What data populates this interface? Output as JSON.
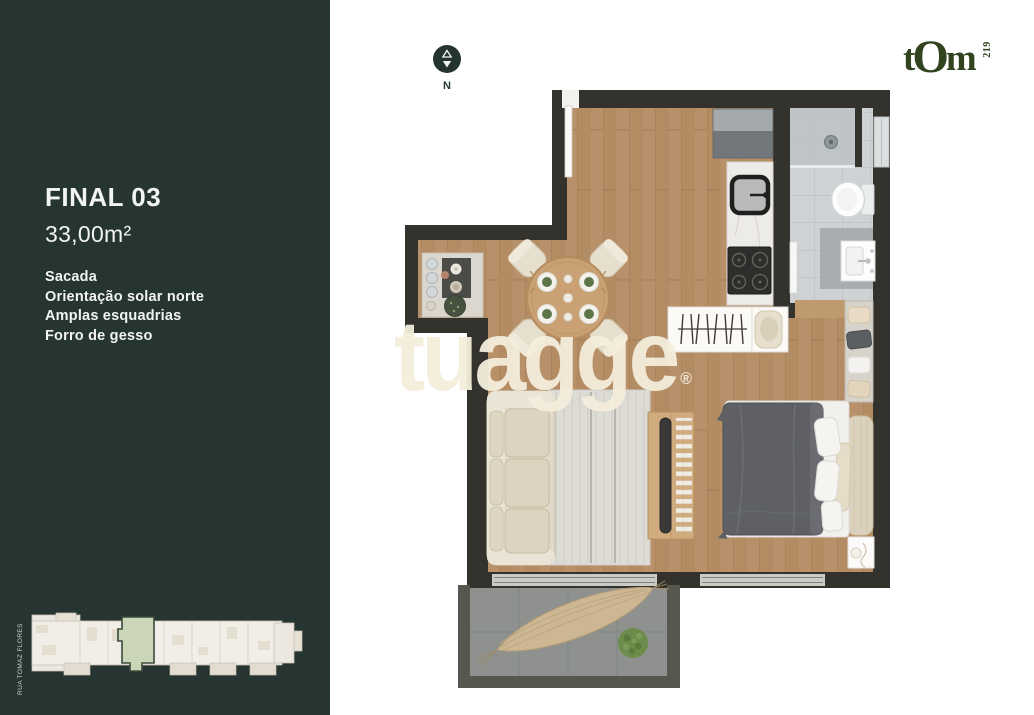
{
  "sidebar": {
    "unit_label": "FINAL 03",
    "area_label": "33,00m²",
    "features": [
      "Sacada",
      "Orientação solar norte",
      "Amplas esquadrias",
      "Forro de gesso"
    ],
    "keyplan": {
      "street_label": "RUA TOMAZ FLORES"
    }
  },
  "header": {
    "compass_label": "N",
    "brand_parts": [
      "t",
      "O",
      "m"
    ],
    "brand_number": "219"
  },
  "watermark": {
    "text": "tuagge",
    "reg": "®"
  },
  "colors": {
    "sidebar_bg": "#263531",
    "wall": "#34322c",
    "wood_floor": "#b8916a",
    "bathroom_tile": "#ced2d4",
    "balcony_floor": "#8e918d",
    "keyplan_highlight": "#cbd6b9",
    "brand_green": "#32431f",
    "watermark_cream": "#f2ecdb"
  }
}
